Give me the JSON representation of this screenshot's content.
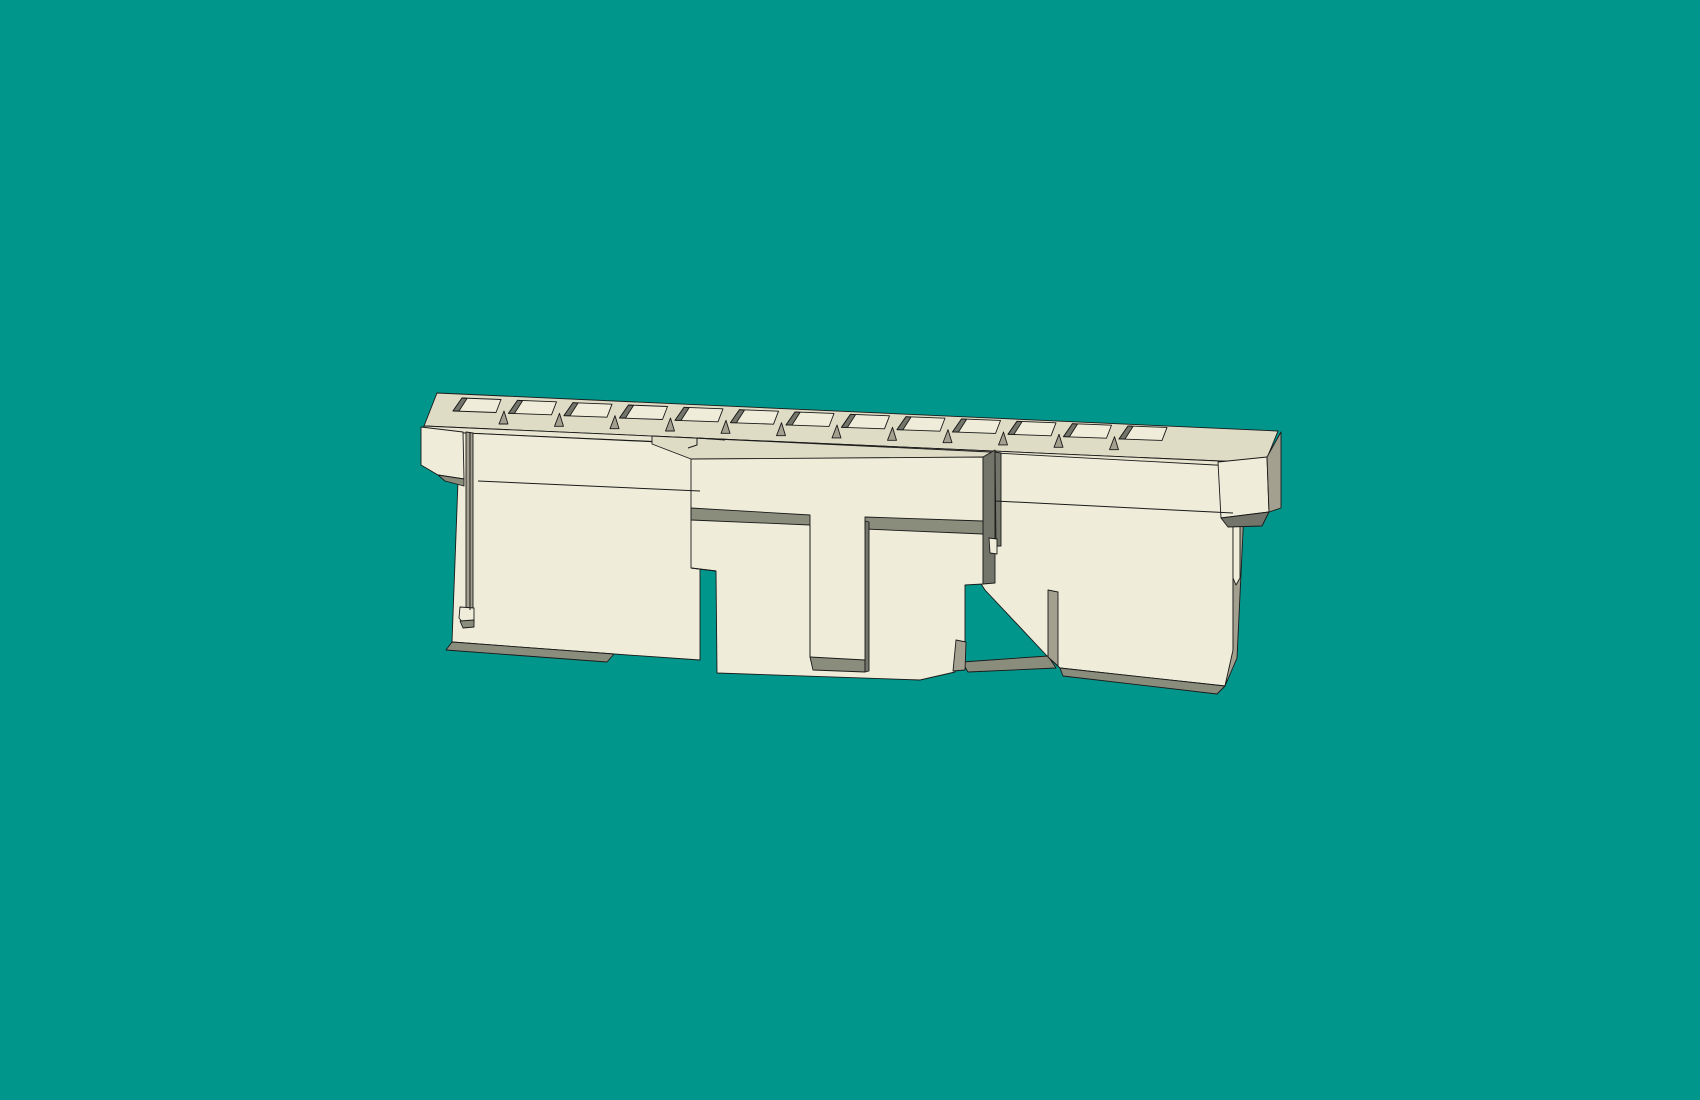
{
  "scene": {
    "description": "3D CAD shaded render of a cream plastic ribbon-cable connector housing (slotted rail, T-shaped latch cover, end flanges) centered on a solid teal viewport background",
    "background_color": "#00968B",
    "canvas": {
      "width": 1700,
      "height": 1100
    },
    "palette": {
      "face": "#EFEDD9",
      "top": "#DFDCC6",
      "lip": "#E8E5D1",
      "shadow": "#8B8D7C",
      "side": "#A4A090",
      "dark": "#73756A",
      "outline": "#1A1A1A"
    },
    "slot_row": {
      "count": 13,
      "x0": 453,
      "pitch": 55.5,
      "y0": 411,
      "slope": 0.042,
      "floor_offsets": [
        [
          0,
          0
        ],
        [
          9,
          -13
        ],
        [
          48,
          -11.5
        ],
        [
          43,
          1.5
        ]
      ],
      "wedge_offsets": [
        [
          0,
          0
        ],
        [
          9,
          -13
        ],
        [
          14,
          -12.5
        ],
        [
          6,
          0
        ]
      ],
      "gap_wedge_offsets": [
        [
          46,
          13
        ],
        [
          51,
          0
        ],
        [
          55,
          13
        ]
      ]
    },
    "polygons": [
      {
        "name": "rail-top-face",
        "fill": "top",
        "points": [
          [
            437,
            393
          ],
          [
            1278,
            431
          ],
          [
            1265,
            463
          ],
          [
            424,
            426
          ]
        ]
      },
      {
        "name": "rail-front-lip",
        "fill": "lip",
        "points": [
          [
            424,
            426
          ],
          [
            1265,
            463
          ],
          [
            1262,
            469
          ],
          [
            422,
            431
          ]
        ]
      },
      {
        "name": "left-block-face",
        "fill": "face",
        "points": [
          [
            422,
            431
          ],
          [
            700,
            444
          ],
          [
            700,
            660
          ],
          [
            614,
            654
          ],
          [
            452,
            642
          ],
          [
            458,
            481
          ],
          [
            440,
            435
          ]
        ]
      },
      {
        "name": "left-block-bottom-shadow",
        "fill": "shadow",
        "points": [
          [
            452,
            642
          ],
          [
            614,
            654
          ],
          [
            607,
            662
          ],
          [
            446,
            650
          ]
        ]
      },
      {
        "name": "left-groove-wall",
        "fill": "side",
        "points": [
          [
            466,
            432
          ],
          [
            473,
            433
          ],
          [
            473,
            611
          ],
          [
            466,
            610
          ]
        ]
      },
      {
        "name": "left-groove-nub",
        "fill": "face",
        "points": [
          [
            460,
            607
          ],
          [
            474,
            608
          ],
          [
            474,
            622
          ],
          [
            464,
            624
          ],
          [
            459,
            618
          ]
        ]
      },
      {
        "name": "left-groove-nub-shadow",
        "fill": "shadow",
        "points": [
          [
            460,
            621
          ],
          [
            474,
            620
          ],
          [
            474,
            627
          ],
          [
            463,
            628
          ]
        ]
      },
      {
        "name": "left-cap-face",
        "fill": "face",
        "points": [
          [
            421,
            427
          ],
          [
            463,
            432
          ],
          [
            464,
            479
          ],
          [
            438,
            475
          ],
          [
            421,
            465
          ]
        ]
      },
      {
        "name": "left-cap-bottom-shadow",
        "fill": "shadow",
        "points": [
          [
            438,
            475
          ],
          [
            464,
            479
          ],
          [
            464,
            486
          ],
          [
            445,
            481
          ]
        ]
      },
      {
        "name": "right-block-face",
        "fill": "face",
        "points": [
          [
            940,
            450
          ],
          [
            1233,
            466
          ],
          [
            1233,
            652
          ],
          [
            1225,
            686
          ],
          [
            1060,
            668
          ],
          [
            1048,
            657
          ],
          [
            985,
            590
          ],
          [
            940,
            520
          ]
        ]
      },
      {
        "name": "right-block-shadow-inner",
        "fill": "shadow",
        "points": [
          [
            962,
            662
          ],
          [
            1048,
            656
          ],
          [
            1056,
            668
          ],
          [
            968,
            672
          ]
        ]
      },
      {
        "name": "right-block-bottom-shadow",
        "fill": "shadow",
        "points": [
          [
            1060,
            668
          ],
          [
            1225,
            686
          ],
          [
            1217,
            694
          ],
          [
            1063,
            676
          ]
        ]
      },
      {
        "name": "right-step-side",
        "fill": "side",
        "points": [
          [
            1048,
            590
          ],
          [
            1058,
            592
          ],
          [
            1058,
            666
          ],
          [
            1048,
            657
          ]
        ]
      },
      {
        "name": "body-right-side",
        "fill": "side",
        "points": [
          [
            1233,
            466
          ],
          [
            1246,
            468
          ],
          [
            1237,
            658
          ],
          [
            1225,
            686
          ],
          [
            1233,
            650
          ]
        ]
      },
      {
        "name": "right-side-slot",
        "fill": "face",
        "points": [
          [
            1233,
            523
          ],
          [
            1240,
            524
          ],
          [
            1240,
            578
          ],
          [
            1236,
            585
          ],
          [
            1233,
            578
          ]
        ]
      },
      {
        "name": "right-cap-face",
        "fill": "face",
        "points": [
          [
            1218,
            462
          ],
          [
            1267,
            457
          ],
          [
            1269,
            512
          ],
          [
            1221,
            518
          ]
        ]
      },
      {
        "name": "right-cap-side",
        "fill": "side",
        "points": [
          [
            1267,
            457
          ],
          [
            1281,
            432
          ],
          [
            1281,
            508
          ],
          [
            1269,
            512
          ]
        ]
      },
      {
        "name": "right-cap-bottom-shadow",
        "fill": "dark",
        "points": [
          [
            1221,
            518
          ],
          [
            1269,
            512
          ],
          [
            1262,
            526
          ],
          [
            1228,
            527
          ]
        ]
      },
      {
        "name": "latch-top-band",
        "fill": "top",
        "points": [
          [
            652,
            436
          ],
          [
            990,
            452
          ],
          [
            995,
            452
          ],
          [
            983,
            460
          ],
          [
            691,
            459
          ],
          [
            652,
            444
          ]
        ]
      },
      {
        "name": "latch-cover-face",
        "fill": "face",
        "points": [
          [
            691,
            459
          ],
          [
            983,
            457
          ],
          [
            983,
            584
          ],
          [
            965,
            585
          ],
          [
            965,
            650
          ],
          [
            955,
            672
          ],
          [
            920,
            680
          ],
          [
            717,
            673
          ],
          [
            716,
            571
          ],
          [
            691,
            568
          ]
        ]
      },
      {
        "name": "latch-right-side",
        "fill": "dark",
        "points": [
          [
            983,
            457
          ],
          [
            995,
            450
          ],
          [
            995,
            583
          ],
          [
            983,
            584
          ]
        ]
      },
      {
        "name": "latch-groove-left",
        "fill": "shadow",
        "points": [
          [
            691,
            508
          ],
          [
            810,
            515
          ],
          [
            810,
            525
          ],
          [
            691,
            520
          ]
        ]
      },
      {
        "name": "latch-groove-right",
        "fill": "shadow",
        "points": [
          [
            865,
            517
          ],
          [
            983,
            521
          ],
          [
            983,
            534
          ],
          [
            865,
            529
          ]
        ]
      },
      {
        "name": "latch-stem-bottom-groove",
        "fill": "shadow",
        "points": [
          [
            810,
            657
          ],
          [
            865,
            660
          ],
          [
            865,
            672
          ],
          [
            813,
            670
          ]
        ]
      },
      {
        "name": "latch-stem-right-edge",
        "fill": "dark",
        "points": [
          [
            865,
            521
          ],
          [
            869,
            522
          ],
          [
            869,
            671
          ],
          [
            865,
            672
          ]
        ]
      },
      {
        "name": "latch-corner-dark",
        "fill": "side",
        "points": [
          [
            956,
            640
          ],
          [
            966,
            642
          ],
          [
            965,
            670
          ],
          [
            953,
            671
          ]
        ]
      },
      {
        "name": "gap-sliver",
        "fill": "dark",
        "points": [
          [
            995,
            452
          ],
          [
            1001,
            453
          ],
          [
            1001,
            546
          ],
          [
            996,
            546
          ]
        ]
      },
      {
        "name": "gap-nub",
        "fill": "face",
        "points": [
          [
            989,
            538
          ],
          [
            997,
            539
          ],
          [
            997,
            554
          ],
          [
            990,
            553
          ]
        ]
      }
    ],
    "lines": [
      {
        "name": "left-block-crease",
        "points": [
          [
            478,
            481
          ],
          [
            700,
            491
          ]
        ]
      },
      {
        "name": "right-block-crease",
        "points": [
          [
            995,
            501
          ],
          [
            1233,
            513
          ]
        ]
      },
      {
        "name": "latch-notch",
        "points": [
          [
            688,
            448
          ],
          [
            697,
            445
          ],
          [
            697,
            438
          ],
          [
            725,
            440
          ]
        ]
      },
      {
        "name": "latch-step",
        "points": [
          [
            691,
            568
          ],
          [
            716,
            571
          ]
        ]
      },
      {
        "name": "latch-stem-left-edge",
        "points": [
          [
            810,
            525
          ],
          [
            810,
            657
          ]
        ]
      },
      {
        "name": "left-groove-line",
        "points": [
          [
            470,
            432
          ],
          [
            470,
            610
          ]
        ]
      }
    ]
  }
}
